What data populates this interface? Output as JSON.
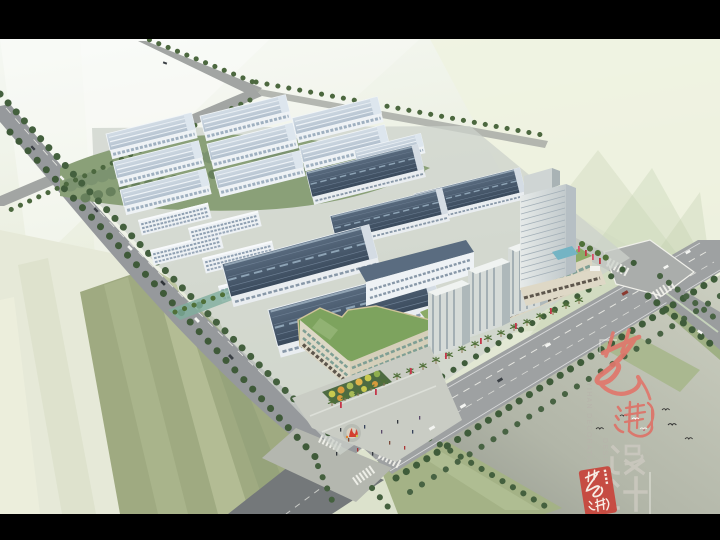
{
  "image": {
    "kind": "aerial architectural rendering",
    "subject": "industrial park master plan: rows of factories with light and dark roofs, dormitory slabs, a high-rise tower, mid-rise towers over a commercial street, tree-lined roads and two major intersections",
    "letterbox_color": "#000000"
  },
  "palette": {
    "sky": "#f2f6ef",
    "far_field": "#e4ead2",
    "field_green": "#a9b58b",
    "forest_green": "#7c9370",
    "lawn_green": "#a4b286",
    "road_gray": "#9a9ea0",
    "dark_roof": "#46586a",
    "light_roof": "#c9d4df",
    "commercial_roof_green": "#7da35e",
    "facade_cream": "#dbd5c2",
    "accent_red": "#c4374b"
  },
  "watermark": {
    "brand_calligraphy": "艺瀚",
    "brand_calligraphy_color": "#e0776c",
    "subtitle": "设计",
    "subtitle_color": "#ccc9c0",
    "vertical_line_1": "YIHAN DECORATION",
    "vertical_line_2": "DESIGN",
    "vertical_text_color": "#b7b4ab",
    "seal_text": "艺瀚",
    "seal_color": "#c7473d"
  }
}
